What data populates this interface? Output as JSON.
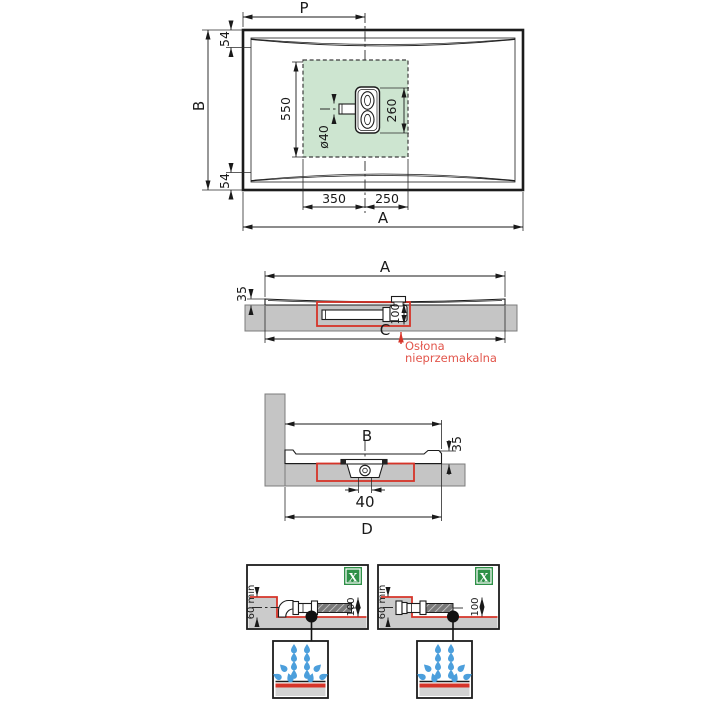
{
  "top_view": {
    "label_p": "P",
    "label_b": "B",
    "label_a": "A",
    "dim_rim_top": "54",
    "dim_rim_bottom": "54",
    "dim_drain_zone_height": "550",
    "dim_drain_length": "260",
    "dim_pipe_diameter": "ø40",
    "dim_drain_left": "350",
    "dim_drain_right": "250"
  },
  "side_section": {
    "label_a": "A",
    "dim_edge_height": "35",
    "dim_recess_depth": "100",
    "label_c": "C",
    "note_line1": "Osłona",
    "note_line2": "nieprzemakalna"
  },
  "wall_section": {
    "label_b": "B",
    "dim_edge_height": "35",
    "dim_outlet": "40",
    "label_d": "D"
  },
  "details": {
    "left": {
      "dim_min_depth": "60 min",
      "dim_recess_depth": "100",
      "badge": "X"
    },
    "right": {
      "dim_min_depth": "60 min",
      "dim_recess_depth": "100",
      "badge": "X"
    }
  },
  "colors": {
    "line": "#1c1c1c",
    "concrete_gray": "#c5c5c5",
    "waterproofing_red": "#d63429",
    "note_red": "#e2564c",
    "drain_zone_green": "#cde5d0",
    "badge_green": "#2e9047",
    "water_blue": "#4c9fdc"
  }
}
